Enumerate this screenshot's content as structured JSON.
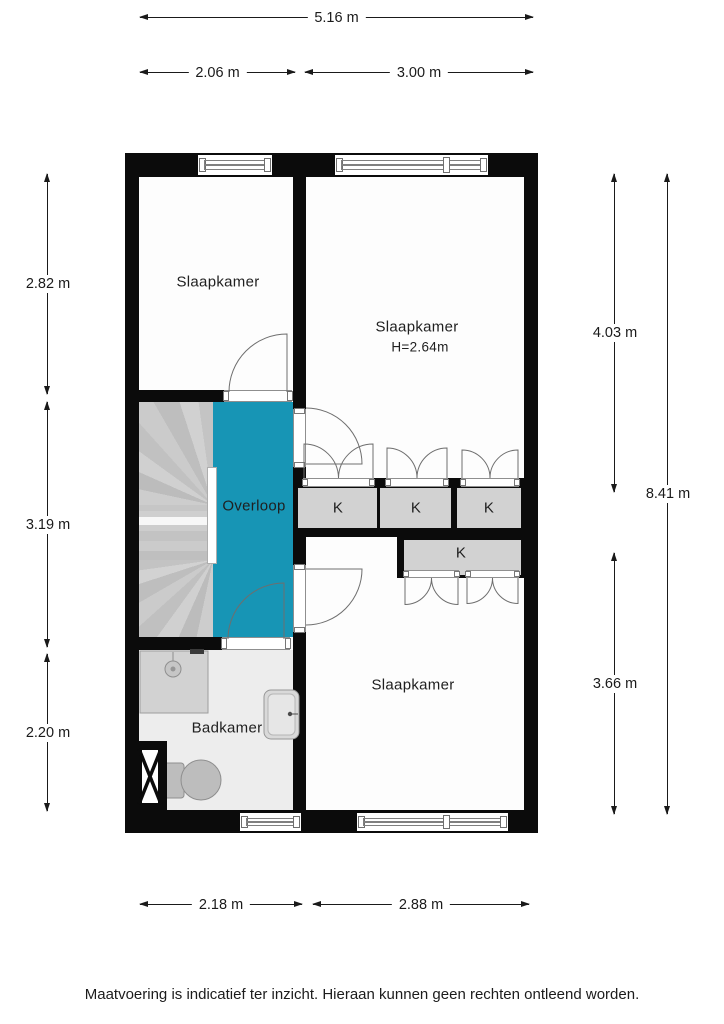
{
  "rooms": {
    "bedroom_top_left": {
      "label": "Slaapkamer"
    },
    "bedroom_top_right": {
      "label": "Slaapkamer",
      "height": "H=2.64m"
    },
    "bedroom_bottom": {
      "label": "Slaapkamer"
    },
    "landing": {
      "label": "Overloop"
    },
    "bathroom": {
      "label": "Badkamer"
    }
  },
  "closets": {
    "labels": [
      "K",
      "K",
      "K",
      "K"
    ]
  },
  "dimensions": {
    "top_total": "5.16 m",
    "top_left": "2.06 m",
    "top_right": "3.00 m",
    "left_top": "2.82 m",
    "left_middle": "3.19 m",
    "left_bottom": "2.20 m",
    "right_top": "4.03 m",
    "right_total": "8.41 m",
    "right_bottom": "3.66 m",
    "bottom_left": "2.18 m",
    "bottom_right": "2.88 m"
  },
  "footer": {
    "disclaimer": "Maatvoering is indicatief ter inzicht. Hieraan kunnen geen rechten ontleend worden."
  },
  "colors": {
    "wall": "#0b0b0b",
    "landing": "#1795b5",
    "closet": "#d2d2d2",
    "stairs": "#c6c6c6",
    "floor": "#fdfdfd",
    "bathfloor": "#ededed",
    "line": "#1a1a1a"
  }
}
